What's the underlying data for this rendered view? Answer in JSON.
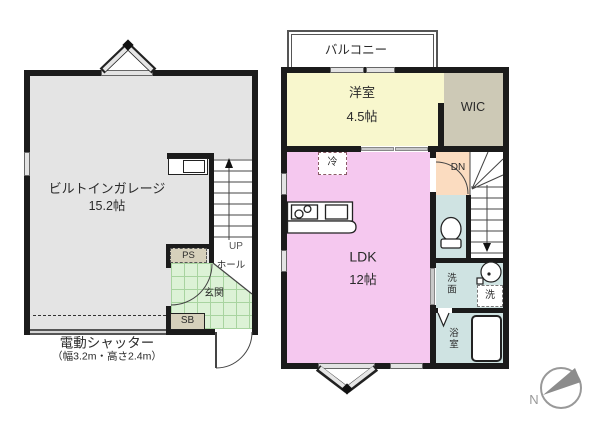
{
  "first_floor": {
    "garage": {
      "name": "ビルトインガレージ",
      "size": "15.2帖"
    },
    "ps": "PS",
    "sb": "SB",
    "hall": "ホール",
    "entrance": "玄関",
    "up_label": "UP",
    "shutter": {
      "title": "電動シャッター",
      "spec": "（幅3.2m・高さ2.4m）"
    }
  },
  "second_floor": {
    "balcony": "バルコニー",
    "western_room": {
      "name": "洋室",
      "size": "4.5帖"
    },
    "wic": "WIC",
    "fridge": "冷",
    "ldk": {
      "name": "LDK",
      "size": "12帖"
    },
    "dn_label": "DN",
    "washroom": "洗面",
    "washer": "洗",
    "bathroom": "浴室"
  },
  "compass": {
    "north": "N"
  },
  "colors": {
    "wall": "#1b1b1b",
    "garage_gray": "#e4e4e4",
    "entrance_tile_green": "#dcf2d6",
    "closet_beige": "#d6d0bb",
    "room_yellow": "#f8f7cd",
    "wic_gray": "#cdc9b6",
    "ldk_pink": "#f5c8ef",
    "stair_peach": "#fbdcc0",
    "wet_area_teal": "#cfe3e2",
    "compass_needle_gray": "#8c8c8c"
  }
}
